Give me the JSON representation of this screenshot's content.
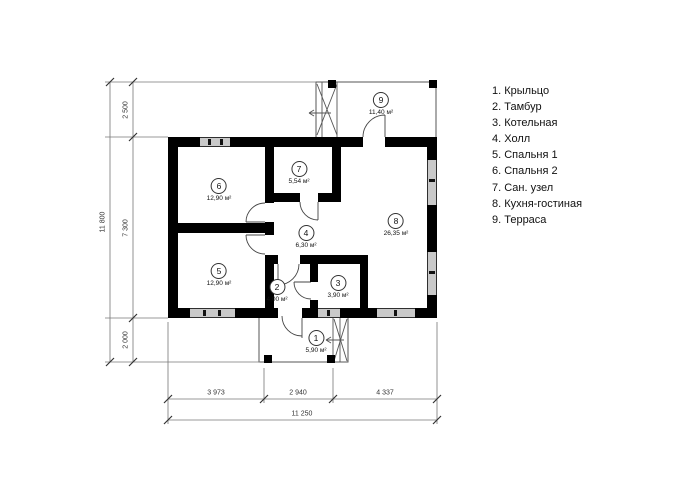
{
  "legend": {
    "items": [
      "1. Крыльцо",
      "2. Тамбур",
      "3. Котельная",
      "4. Холл",
      "5. Спальня 1",
      "6. Спальня 2",
      "7. Сан. узел",
      "8. Кухня-гостиная",
      "9. Терраса"
    ]
  },
  "rooms": {
    "r1": {
      "number": "1",
      "area": "5,90 м²"
    },
    "r2": {
      "number": "2",
      "area": "4,00 м²"
    },
    "r3": {
      "number": "3",
      "area": "3,90 м²"
    },
    "r4": {
      "number": "4",
      "area": "6,30 м²"
    },
    "r5": {
      "number": "5",
      "area": "12,90 м²"
    },
    "r6": {
      "number": "6",
      "area": "12,90 м²"
    },
    "r7": {
      "number": "7",
      "area": "5,54 м²"
    },
    "r8": {
      "number": "8",
      "area": "26,35 м²"
    },
    "r9": {
      "number": "9",
      "area": "11,40 м²"
    }
  },
  "dimensions": {
    "left_total": "11 800",
    "left_segments": [
      "2 500",
      "7 300",
      "2 000"
    ],
    "bottom_total": "11 250",
    "bottom_segments": [
      "3 973",
      "2 940",
      "4 337"
    ]
  },
  "colors": {
    "wall": "#000000",
    "window_fill": "#c9c9c9",
    "line": "#555555",
    "text": "#111111"
  }
}
